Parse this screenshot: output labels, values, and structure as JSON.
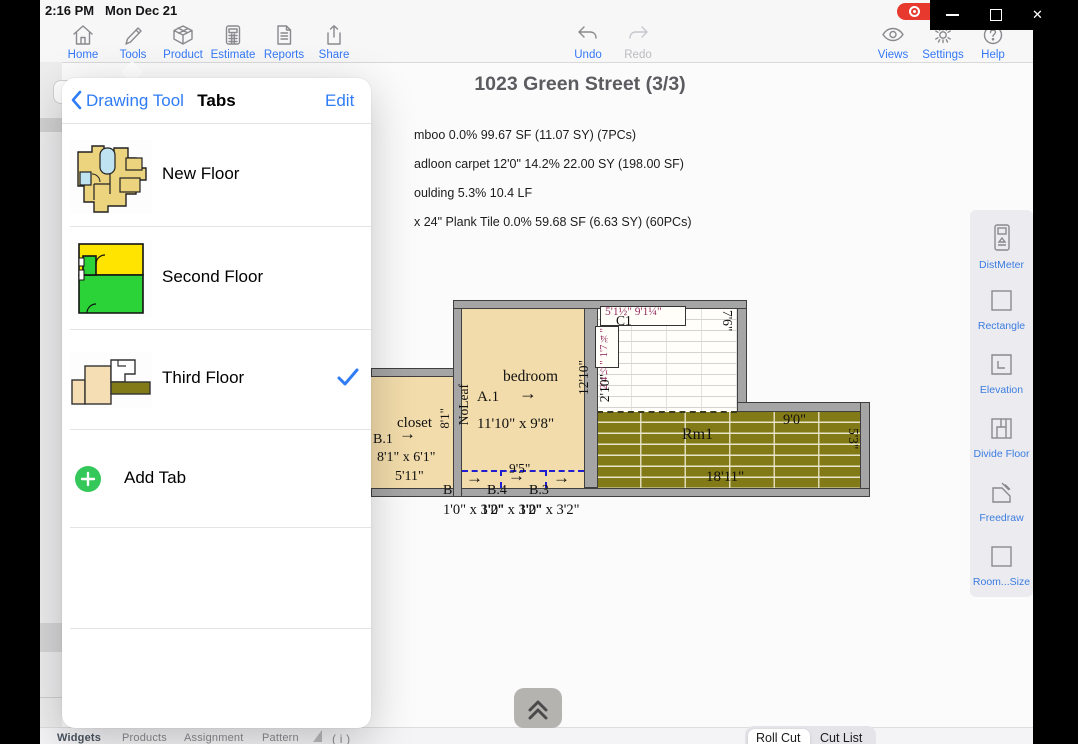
{
  "status_bar": {
    "time": "2:16 PM",
    "date": "Mon Dec 21"
  },
  "window_controls": {
    "close_glyph": "✕"
  },
  "toolbar": {
    "left": [
      {
        "label": "Home",
        "icon": "home-icon"
      },
      {
        "label": "Tools",
        "icon": "pencil-icon"
      },
      {
        "label": "Product",
        "icon": "box-icon"
      },
      {
        "label": "Estimate",
        "icon": "calculator-icon"
      },
      {
        "label": "Reports",
        "icon": "report-icon"
      },
      {
        "label": "Share",
        "icon": "share-icon"
      }
    ],
    "center": [
      {
        "label": "Undo",
        "icon": "undo-icon",
        "enabled": true
      },
      {
        "label": "Redo",
        "icon": "redo-icon",
        "enabled": false
      }
    ],
    "right": [
      {
        "label": "Views",
        "icon": "eye-icon"
      },
      {
        "label": "Settings",
        "icon": "gear-icon"
      },
      {
        "label": "Help",
        "icon": "help-icon"
      }
    ]
  },
  "header": {
    "title": "1023 Green Street (3/3)"
  },
  "estimate_lines": [
    "mboo  0.0% 99.67 SF (11.07 SY) (7PCs)",
    "adloon carpet 12'0\" 14.2% 22.00 SY (198.00 SF)",
    "oulding  5.3% 10.4 LF",
    "x 24\" Plank Tile  0.0% 59.68 SF (6.63 SY) (60PCs)"
  ],
  "popover": {
    "back_label": "Drawing Tool",
    "title": "Tabs",
    "edit_label": "Edit",
    "tabs": [
      {
        "label": "New Floor",
        "selected": false
      },
      {
        "label": "Second Floor",
        "selected": false
      },
      {
        "label": "Third Floor",
        "selected": true
      }
    ],
    "add_tab_label": "Add Tab"
  },
  "tools_panel": {
    "items": [
      {
        "label": "DistMeter",
        "icon": "distmeter-icon"
      },
      {
        "label": "Rectangle",
        "icon": "rectangle-icon"
      },
      {
        "label": "Elevation",
        "icon": "elevation-icon"
      },
      {
        "label": "Divide Floor",
        "icon": "divide-floor-icon"
      },
      {
        "label": "Freedraw",
        "icon": "freedraw-icon"
      },
      {
        "label": "Room...Size",
        "icon": "room-size-icon"
      }
    ]
  },
  "floor_plan": {
    "closet": {
      "name": "closet",
      "id": "B.1",
      "size": "8'1\" x 6'1\"",
      "width_dim": "5'11\"",
      "height_dim": "8'1\""
    },
    "bedroom": {
      "name": "bedroom",
      "id": "A.1",
      "size": "11'10\" x 9'8\"",
      "height_dim": "12'10\"",
      "wall_note": "NoLeaf",
      "door_dim": "9'5\""
    },
    "tile_room": {
      "id": "C1",
      "top_dims": "5'1½\" 9'1¼\"",
      "side_dims": "2'4½\" 1'7¾\"",
      "left_dim": "2'10\"",
      "right_dim": "7'6\""
    },
    "plank_room": {
      "id": "Rm1",
      "top_dim": "9'0\"",
      "bottom_dim": "18'11\"",
      "right_dim": "5'3\""
    },
    "door_labels": [
      "B.2",
      "B.4",
      "B.3"
    ],
    "door_sizes": [
      "1'0\" x 3'2\"",
      "1'0\" x 3'2\"",
      "1'0\" x 3'2\""
    ],
    "arrow_glyph": "→"
  },
  "bottom_bar": {
    "tabs": [
      "Widgets",
      "Products",
      "Assignment",
      "Pattern"
    ],
    "info": "( i )",
    "cut_tabs": [
      "Roll Cut",
      "Cut List"
    ],
    "selected_cut_tab": "Roll Cut"
  },
  "colors": {
    "accent_blue": "#2f7cf6",
    "record_red": "#e8392e",
    "add_green": "#34c759",
    "room_wheat": "#f2dcab",
    "plank_olive": "#827a16",
    "thumb_yellow": "#ffe400",
    "thumb_green": "#2bd338",
    "dim_magenta": "#993366",
    "dashed_door_blue": "#1f1fd0"
  }
}
